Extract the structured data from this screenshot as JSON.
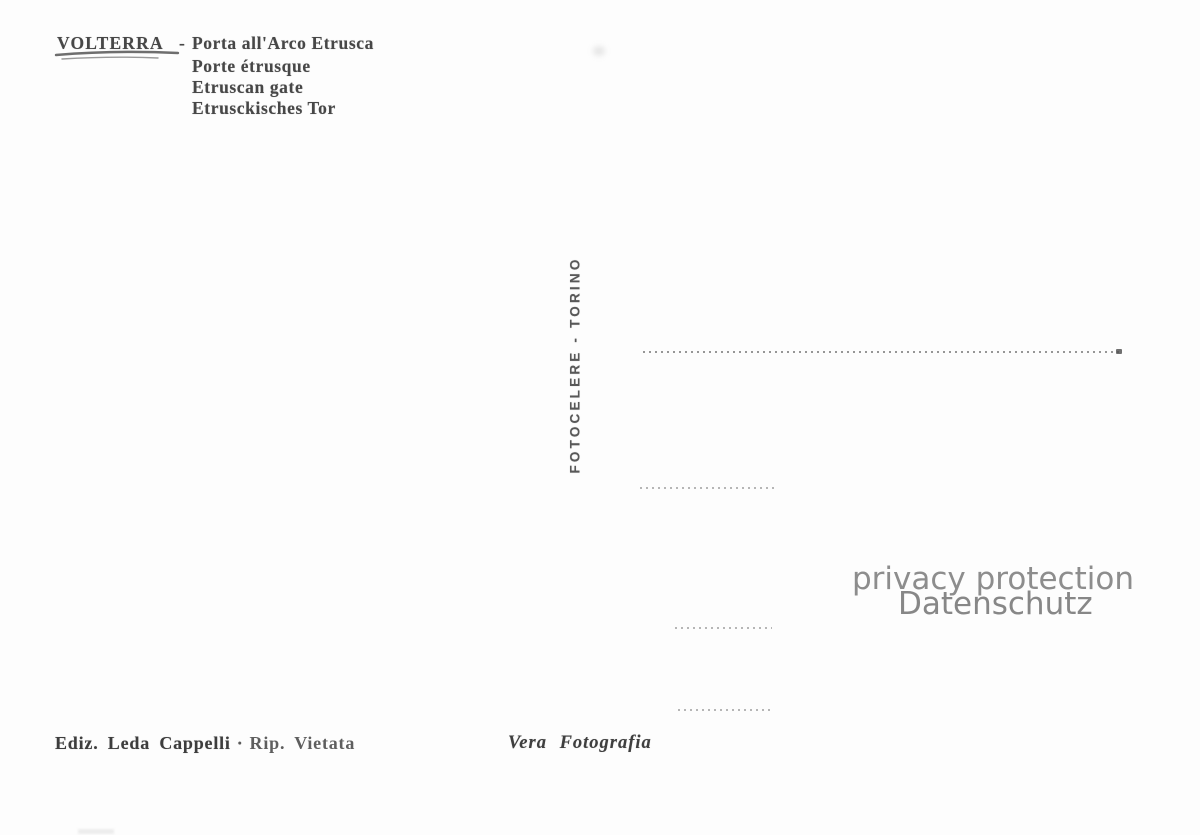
{
  "header": {
    "title": "VOLTERRA",
    "separator": "-",
    "caption_it": "Porta all'Arco Etrusca",
    "caption_fr": "Porte étrusque",
    "caption_en": "Etruscan gate",
    "caption_de": "Etrusckisches Tor"
  },
  "publisher": {
    "vertical_text": "FOTOCELERE - TORINO"
  },
  "watermark": {
    "line1": "privacy protection",
    "line2": "Datenschutz"
  },
  "footer": {
    "edition": "Ediz. Leda Cappelli",
    "separator": "·",
    "rights": "Rip. Vietata",
    "authenticity": "Vera Fotografia"
  },
  "colors": {
    "paper": "#fdfdfd",
    "ink": "#474747",
    "faded_ink": "#5e5e5e",
    "watermark": "#8d8d8d",
    "dotted_line": "#6e6e6e"
  }
}
